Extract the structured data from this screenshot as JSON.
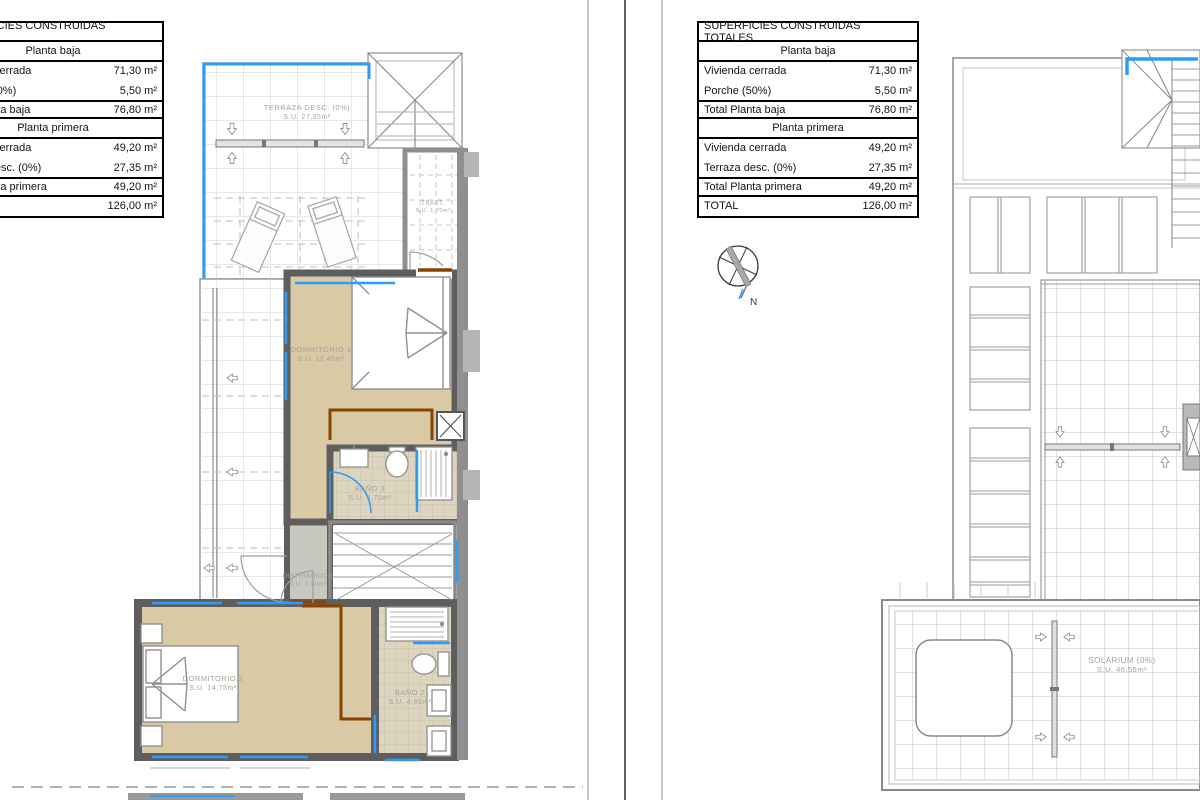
{
  "area_table": {
    "title": "SUPERFICIES CONSTRUIDAS TOTALES",
    "sections": [
      {
        "header": "Planta baja",
        "rows": [
          {
            "label": "Vivienda cerrada",
            "value": "71,30 m²"
          },
          {
            "label": "Porche (50%)",
            "value": "5,50 m²"
          },
          {
            "label": "Total Planta baja",
            "value": "76,80 m²"
          }
        ]
      },
      {
        "header": "Planta primera",
        "rows": [
          {
            "label": "Vivienda cerrada",
            "value": "49,20 m²"
          },
          {
            "label": "Terraza desc. (0%)",
            "value": "27,35 m²"
          },
          {
            "label": "Total Planta primera",
            "value": "49,20 m²"
          }
        ]
      }
    ],
    "total": {
      "label": "TOTAL",
      "value": "126,00 m²"
    }
  },
  "rooms_left": {
    "terraza": {
      "name": "TERRAZA DESC. (0%)",
      "area": "S.U. 27,35m²"
    },
    "trastero": {
      "name": "TRAST.",
      "area": "S.U. 1,70m²"
    },
    "dormitorio3": {
      "name": "DORMITORIO 3",
      "area": "S.U. 12,45m²"
    },
    "bano3": {
      "name": "BAÑO 3",
      "area": "S.U. 3,75m²"
    },
    "distribuidor": {
      "name": "DISTRIBUIDOR",
      "area": "S.U. 1,80m²"
    },
    "dormitorio2": {
      "name": "DORMITORIO 2",
      "area": "S.U. 14,75m²"
    },
    "bano2": {
      "name": "BAÑO 2",
      "area": "S.U. 4,95m²"
    }
  },
  "rooms_right": {
    "solarium": {
      "name": "SOLARIUM (0%)",
      "area": "S.U. 46,55m²"
    }
  },
  "compass": {
    "label": "N"
  },
  "colors": {
    "window_blue": "#2e9bf7",
    "wood_brown": "#8a4200",
    "floor_tan": "#d9caa5",
    "bath_tile": "#ded5c1",
    "wall_gray": "#5e5e5e",
    "label_gray": "#a2a29a"
  }
}
